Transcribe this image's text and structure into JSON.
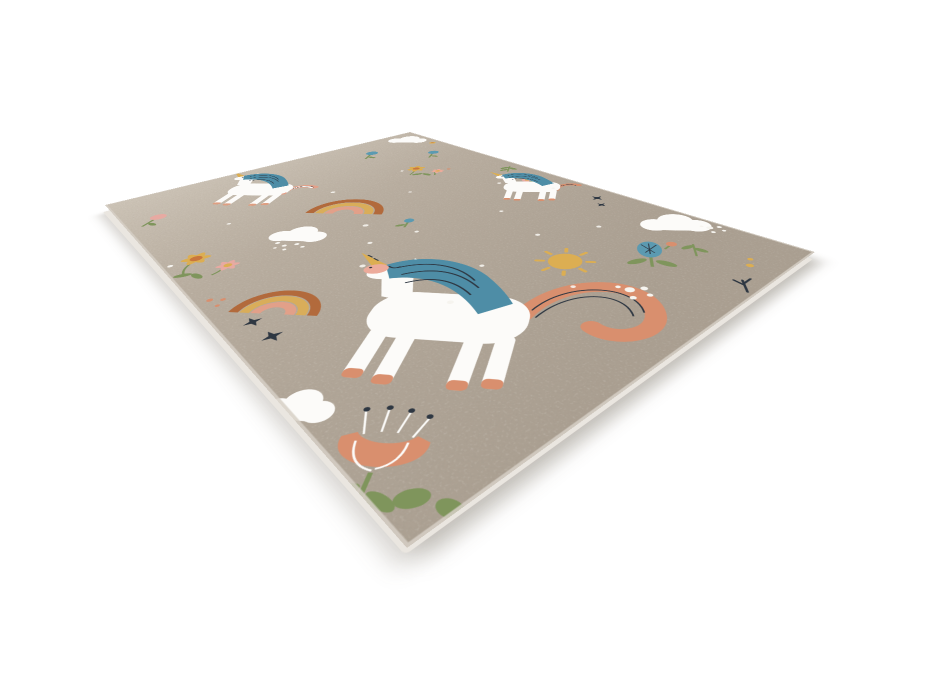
{
  "meta": {
    "type": "product-photo",
    "description": "Studio photograph of a rectangular children's play rug lying on a plain white background, viewed in perspective from its front corner. The rug has a beige melange pile printed with cartoon unicorns and pastel garden motifs; a narrow cream pile edge is visible along the two near sides.",
    "background": "plain white studio backdrop",
    "visible_text": ""
  },
  "palette": {
    "page_bg": "#ffffff",
    "rug_base": "#b8ad9f",
    "rug_base_far": "#ccc3b6",
    "rug_base_near": "#aa9f91",
    "rug_edge": "#eae6e0",
    "rug_trim": "#d6cfc5",
    "unicorn_white": "#fcfbf9",
    "dot_white": "#f6f4ef",
    "mane_teal": "#4e8da6",
    "star_navy": "#2e3742",
    "horn_gold": "#d2a049",
    "coral": "#d98f6e",
    "salmon": "#ecab9b",
    "pink": "#e7aaa2",
    "rainbow_sienna": "#b26a3c",
    "rainbow_gold": "#d9ad5a",
    "rainbow_coral": "#e2a089",
    "flower_gold": "#dcae52",
    "flower_orange": "#c9763d",
    "leaf_green": "#7f955c",
    "sky_teal": "#5b9ab1",
    "sun_gold": "#dcae52"
  },
  "rug": {
    "shape": "rectangle seen in perspective, front corner toward viewer",
    "pile": "short beige melange pile with light speckle texture",
    "edge": "pale cream binding visible along the two near edges",
    "motifs": [
      {
        "id": "unicorn-top-left",
        "label": "white unicorn with teal striped mane and striped arc tail"
      },
      {
        "id": "unicorn-right",
        "label": "white unicorn with teal mane and coral striped tail"
      },
      {
        "id": "unicorn-large-front",
        "label": "large white unicorn with gold striped horn, closed eyes, salmon muzzle and big coral swirl tail"
      },
      {
        "id": "rainbow-upper",
        "label": "sienna-gold-coral rainbow"
      },
      {
        "id": "rainbow-lower",
        "label": "small sienna-gold-coral rainbow"
      },
      {
        "id": "cloud-with-rain",
        "label": "scalloped cloud with falling white dots"
      },
      {
        "id": "cloud-right",
        "label": "fluffy white cloud"
      },
      {
        "id": "cloud-back-edge",
        "label": "white cloud at the far edge"
      },
      {
        "id": "cloud-left-edge",
        "label": "partial white cloud at the left edge"
      },
      {
        "id": "sun",
        "label": "golden sun with ray ticks"
      },
      {
        "id": "poppy-flower",
        "label": "large coral poppy with white stamens and green leaves"
      },
      {
        "id": "thistle-flower",
        "label": "teal thistle bloom with coral bud and leaves"
      },
      {
        "id": "flower-cluster-left",
        "label": "gold and pink flower cluster with stems"
      },
      {
        "id": "flower-cluster-mid",
        "label": "gold flower cluster with coral accents"
      },
      {
        "id": "pink-tulip",
        "label": "small pink tulip"
      },
      {
        "id": "blue-tulip",
        "label": "small teal tulip"
      },
      {
        "id": "blue-flag-flower",
        "label": "small teal flower on stem"
      },
      {
        "id": "teal-bud",
        "label": "small teal bud"
      },
      {
        "id": "pink-flower-small",
        "label": "small pink flower"
      },
      {
        "id": "tiny-gold-flower",
        "label": "tiny gold flower near far edge"
      },
      {
        "id": "greenery-right",
        "label": "green sprig near right edge"
      },
      {
        "id": "greenery-front",
        "label": "green sprig near front edge"
      },
      {
        "id": "corner-leaves",
        "label": "two green leaves at the near corner"
      },
      {
        "id": "twig",
        "label": "small dark twig"
      },
      {
        "id": "stars-left",
        "label": "dark four-point sparkle stars"
      },
      {
        "id": "stars-right",
        "label": "dark four-point sparkle stars"
      },
      {
        "id": "white-dot-clusters",
        "label": "clusters of white dots"
      },
      {
        "id": "coral-dots",
        "label": "small coral dots"
      },
      {
        "id": "yellow-dots",
        "label": "small gold dots"
      },
      {
        "id": "scatter-dots",
        "label": "scattered white speckle dots"
      }
    ]
  }
}
